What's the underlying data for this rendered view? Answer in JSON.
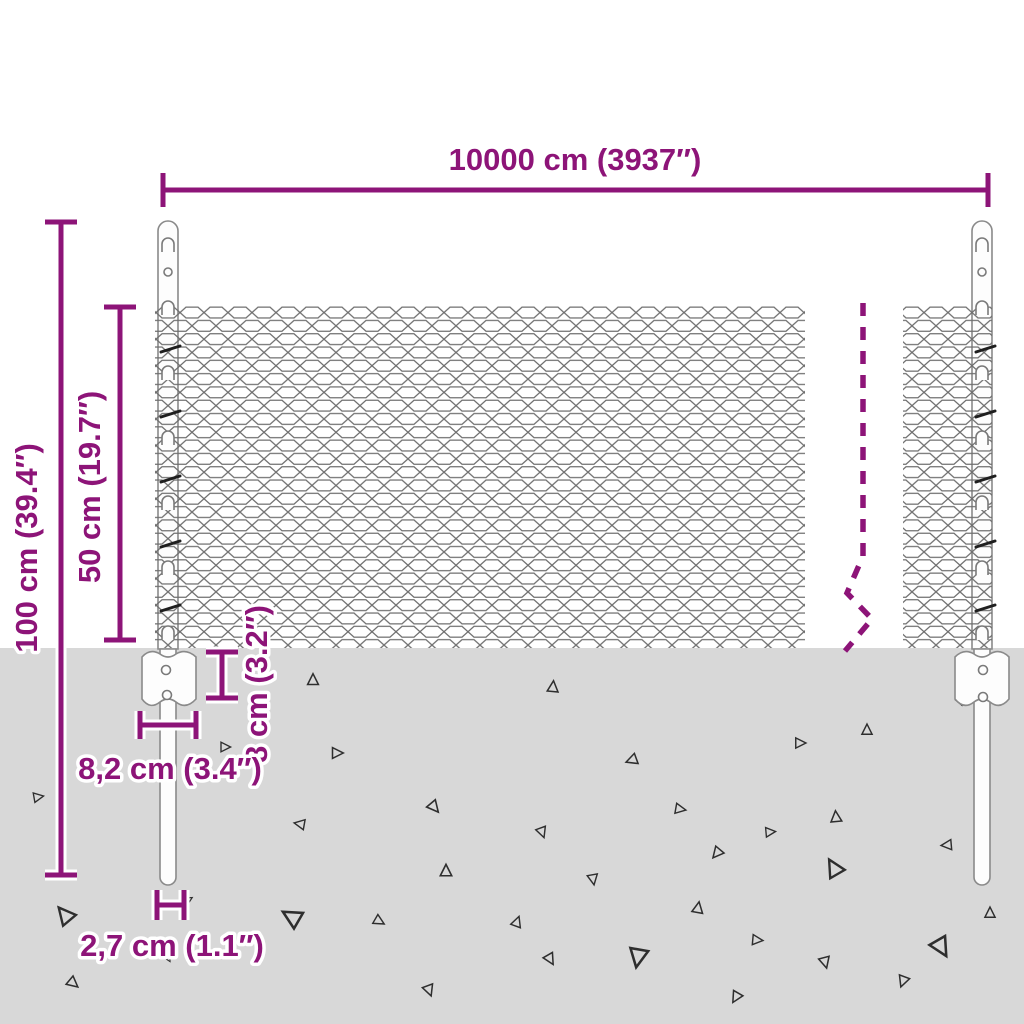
{
  "diagram": {
    "kind": "wire-mesh-fence-dimension-diagram",
    "colors": {
      "dimension": "#8d1478",
      "ground": "#d8d8d8",
      "mesh_wire": "#6e6e6e",
      "post_outline": "#8a8a8a",
      "debris": "#2e2e2e"
    },
    "dims": {
      "total_width": "10000 cm (3937″)",
      "total_height": "100 cm (39.4″)",
      "mesh_height": "50 cm (19.7″)",
      "connector_height": "8 cm (3.2″)",
      "connector_width": "8,2 cm (3.4″)",
      "post_diameter": "2,7 cm (1.1″)"
    }
  }
}
